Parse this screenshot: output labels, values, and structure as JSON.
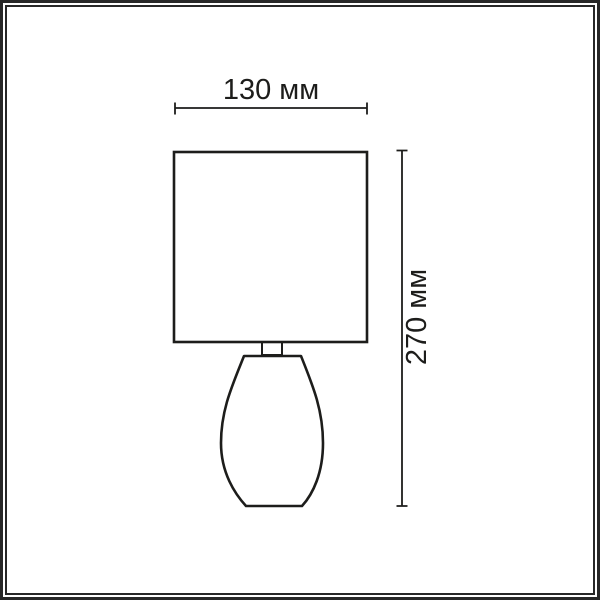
{
  "diagram": {
    "type": "product-dimension-drawing",
    "subject": "table lamp with square shade and teardrop base",
    "line_color": "#1d1d1b",
    "background_color": "#ffffff",
    "frame_color": "#282828"
  },
  "dimensions": {
    "width_label": "130 мм",
    "height_label": "270 мм"
  }
}
